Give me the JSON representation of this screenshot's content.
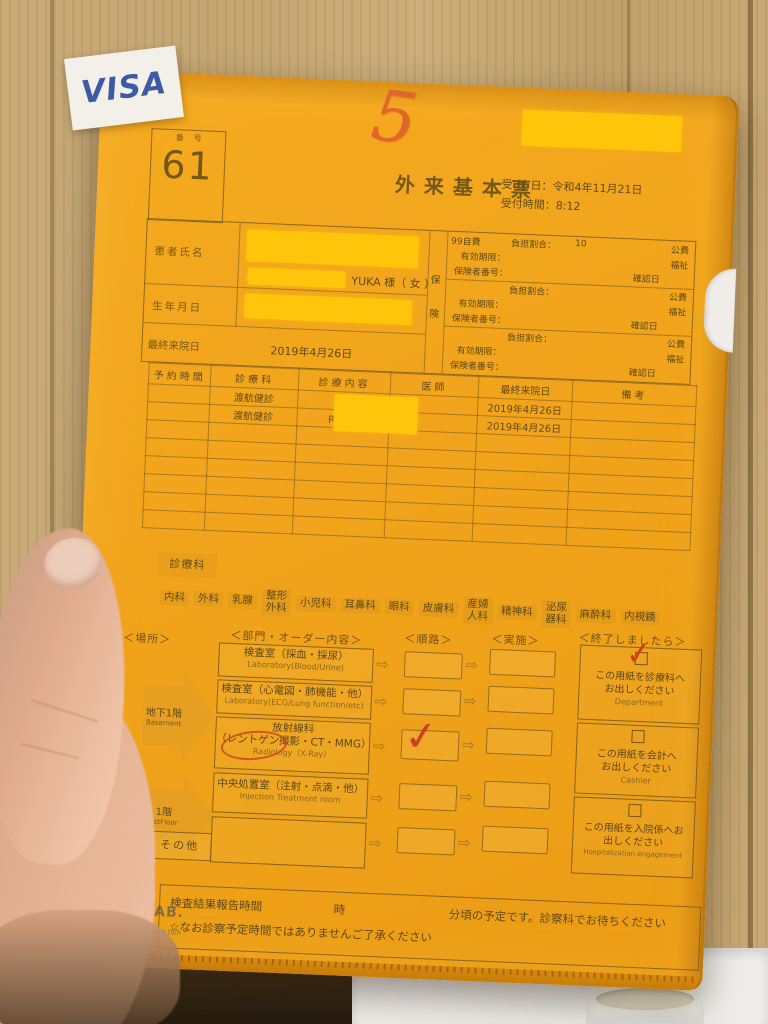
{
  "sticker": {
    "label": "VISA"
  },
  "header": {
    "number_label": "番号",
    "number": "61",
    "handwritten": "5",
    "title": "外来基本票",
    "reception_date_label": "受 付 日：",
    "reception_date": "令和4年11月21日",
    "reception_time_label": "受付時間：",
    "reception_time": "8:12"
  },
  "patient": {
    "name_label": "患者氏名",
    "name_text": "YUKA 様（ 女 ）",
    "dob_label": "生年月日",
    "last_visit_label": "最終来院日",
    "last_visit_value": "2019年4月26日",
    "insurance_tab": [
      "保",
      "険"
    ],
    "insurance_blocks": [
      {
        "code": "99自費",
        "burden_label": "負担割合：",
        "burden_value": "10",
        "public": "公費",
        "validity_label": "有効期限：",
        "welfare": "福祉",
        "insurer_label": "保険者番号：",
        "confirm": "確認日"
      },
      {
        "code": "",
        "burden_label": "負担割合：",
        "burden_value": "",
        "public": "公費",
        "validity_label": "有効期限：",
        "welfare": "福祉",
        "insurer_label": "保険者番号：",
        "confirm": "確認日"
      },
      {
        "code": "",
        "burden_label": "負担割合：",
        "burden_value": "",
        "public": "公費",
        "validity_label": "有効期限：",
        "welfare": "福祉",
        "insurer_label": "保険者番号：",
        "confirm": "確認日"
      }
    ]
  },
  "schedule": {
    "headers": [
      "予約時間",
      "診療科",
      "診療内容",
      "医師",
      "最終来院日",
      "備考"
    ],
    "rows": [
      {
        "dept": "渡航健診",
        "content": "診察",
        "last_visit": "2019年4月26日"
      },
      {
        "dept": "渡航健診",
        "content": "RI検査",
        "last_visit": "2019年4月26日"
      }
    ]
  },
  "departments": {
    "label": "診療科",
    "chips": [
      "内科",
      "外科",
      "乳腺",
      "整形\n外科",
      "小児科",
      "耳鼻科",
      "眼科",
      "皮膚科",
      "産婦\n人科",
      "精神科",
      "泌尿\n器科",
      "麻酔科",
      "内視鏡"
    ]
  },
  "flow": {
    "headers": [
      "＜場所＞",
      "＜部門・オーダー内容＞",
      "＜順路＞",
      "＜実施＞",
      "＜終了しましたら＞"
    ],
    "locations": [
      {
        "jp": "地下1階",
        "en": "Basement"
      },
      {
        "jp": "1階",
        "en": "1stFloor"
      }
    ],
    "other_label": "その他",
    "orders": [
      {
        "line1": "検査室（採血・採尿）",
        "line2": "Laboratory(Blood/Urine)"
      },
      {
        "line1": "検査室（心電図・肺機能・他）",
        "line2": "Laboratory(ECG/Lung function/etc)"
      },
      {
        "line1": "放射線科",
        "line2": "（レントゲン撮影・CT・MMG）",
        "line3": "Radiology（X-Ray）"
      },
      {
        "line1": "中央処置室（注射・点滴・他）",
        "line2": "Injection Treatment room"
      }
    ],
    "finish": [
      {
        "line1": "この用紙を診療科へ",
        "line2": "お出しください",
        "en": "Department"
      },
      {
        "line1": "この用紙を会計へ",
        "line2": "お出しください",
        "en": "Cashier"
      },
      {
        "line1": "この用紙を入院係へお",
        "line2": "出しください",
        "en": "Hospitalization engagement"
      }
    ]
  },
  "footer": {
    "result_label": "検査結果報告時間",
    "hour": "時",
    "rest": "分頃の予定です。診察科でお待ちください",
    "note": "☆なお診察予定時間ではありませんご了承ください"
  },
  "brand": {
    "name": "LIHIT LAB.",
    "model": "78-4-A4",
    "product": "COLOR CLEAR HOLDER"
  },
  "icons": {
    "arrow": "⇨",
    "check": "✓"
  },
  "colors": {
    "folder_orange": "#f0a01c",
    "redaction_yellow": "#ffc50a",
    "sticker_blue": "#3d5ba5",
    "annotation_red": "#ce3f22",
    "ink_brown": "#604a18",
    "wood_beige": "#c7a977"
  }
}
